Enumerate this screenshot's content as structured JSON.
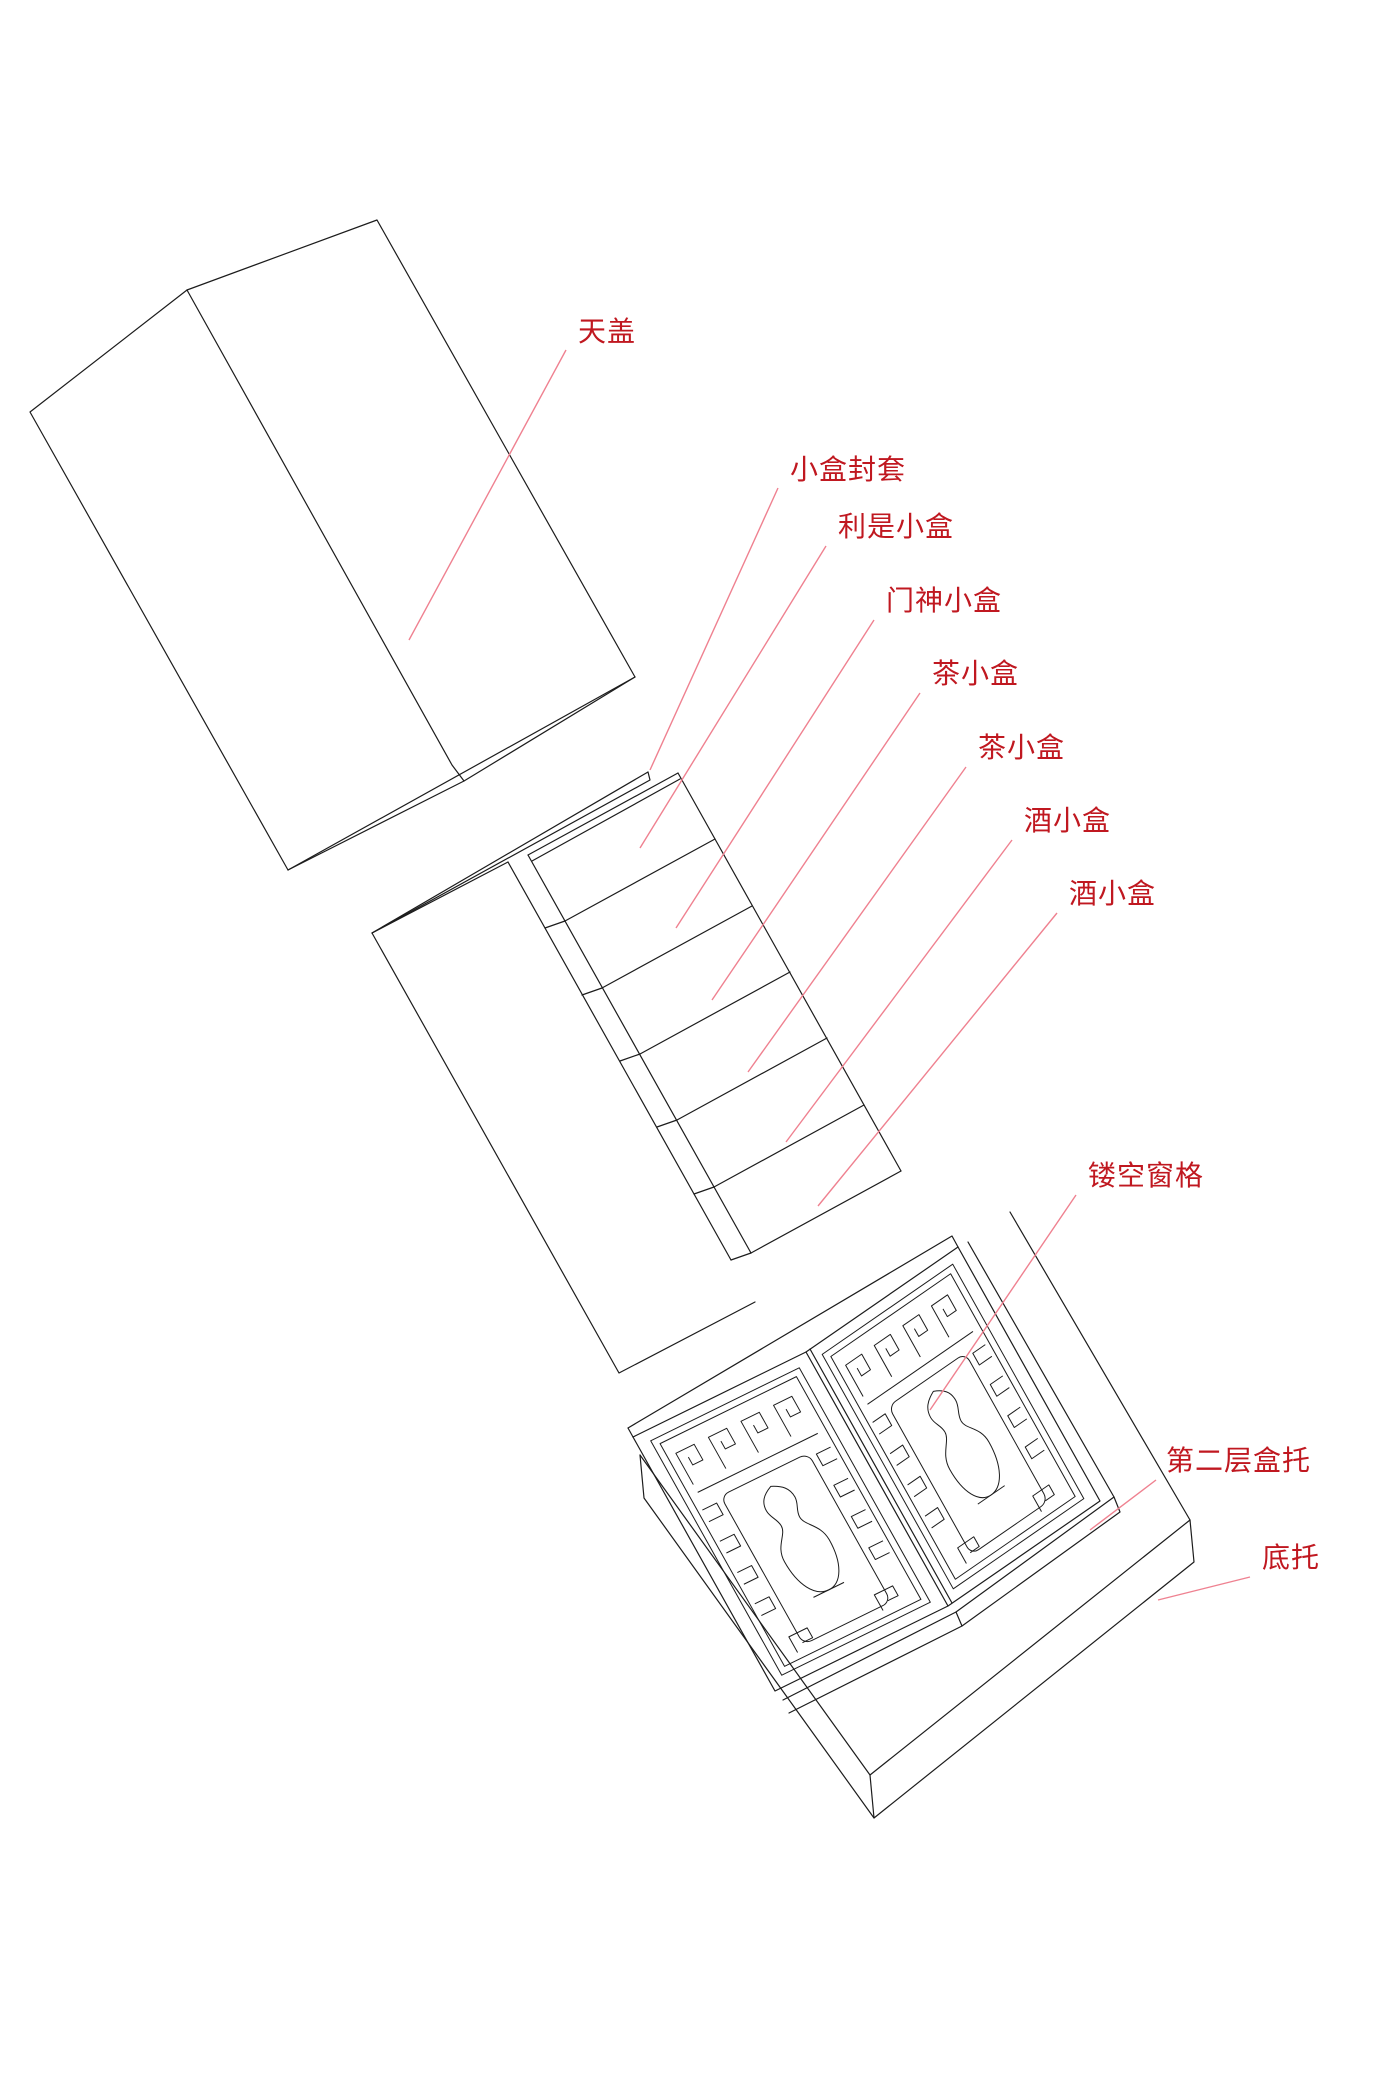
{
  "diagram": {
    "description_labels_language": "zh-CN",
    "colors": {
      "background": "#ffffff",
      "label_text": "#c01820",
      "leader_line": "#ef8190",
      "line_art": "#1c1c1c"
    },
    "labels": [
      {
        "id": "top-lid",
        "text": "天盖",
        "x": 578,
        "y": 341,
        "leader": {
          "x1": 566,
          "y1": 350,
          "x2": 409,
          "y2": 640
        }
      },
      {
        "id": "small-box-sleeve",
        "text": "小盒封套",
        "x": 790,
        "y": 479,
        "leader": {
          "x1": 778,
          "y1": 488,
          "x2": 650,
          "y2": 770
        }
      },
      {
        "id": "lishi-small-box",
        "text": "利是小盒",
        "x": 838,
        "y": 536,
        "leader": {
          "x1": 826,
          "y1": 546,
          "x2": 640,
          "y2": 848
        }
      },
      {
        "id": "menshen-small-box",
        "text": "门神小盒",
        "x": 886,
        "y": 610,
        "leader": {
          "x1": 874,
          "y1": 620,
          "x2": 676,
          "y2": 928
        }
      },
      {
        "id": "tea-small-box-1",
        "text": "茶小盒",
        "x": 932,
        "y": 683,
        "leader": {
          "x1": 920,
          "y1": 693,
          "x2": 712,
          "y2": 1000
        }
      },
      {
        "id": "tea-small-box-2",
        "text": "茶小盒",
        "x": 978,
        "y": 757,
        "leader": {
          "x1": 966,
          "y1": 767,
          "x2": 748,
          "y2": 1072
        }
      },
      {
        "id": "wine-small-box-1",
        "text": "酒小盒",
        "x": 1024,
        "y": 830,
        "leader": {
          "x1": 1012,
          "y1": 840,
          "x2": 786,
          "y2": 1142
        }
      },
      {
        "id": "wine-small-box-2",
        "text": "酒小盒",
        "x": 1069,
        "y": 903,
        "leader": {
          "x1": 1057,
          "y1": 913,
          "x2": 818,
          "y2": 1206
        }
      },
      {
        "id": "lattice-window",
        "text": "镂空窗格",
        "x": 1088,
        "y": 1185,
        "leader": {
          "x1": 1076,
          "y1": 1195,
          "x2": 930,
          "y2": 1410
        }
      },
      {
        "id": "second-layer-tray",
        "text": "第二层盒托",
        "x": 1166,
        "y": 1470,
        "leader": {
          "x1": 1156,
          "y1": 1480,
          "x2": 1090,
          "y2": 1530
        }
      },
      {
        "id": "bottom-tray",
        "text": "底托",
        "x": 1262,
        "y": 1567,
        "leader": {
          "x1": 1250,
          "y1": 1577,
          "x2": 1158,
          "y2": 1600
        }
      }
    ]
  }
}
